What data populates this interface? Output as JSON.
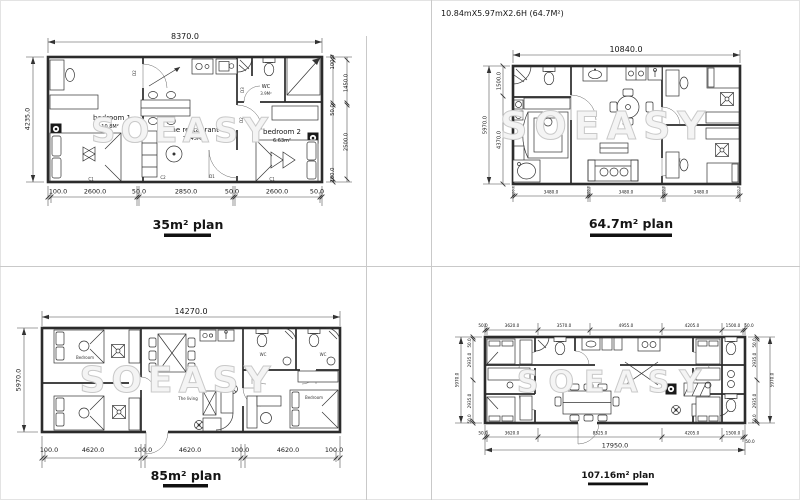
{
  "watermark": "SOEASY",
  "plans": {
    "p35": {
      "title": "35m² plan",
      "dim_top": "8370.0",
      "dim_left": "4235.0",
      "dims_right": [
        "100.0",
        "1450.0",
        "50.0",
        "2500.0",
        "100.0"
      ],
      "dims_bottom": [
        "100.0",
        "2600.0",
        "50.0",
        "2850.0",
        "50.0",
        "2600.0",
        "50.0"
      ],
      "rooms": {
        "bedroom1": {
          "name": "bedroom 1",
          "area": "10.8M²"
        },
        "restaurant": {
          "name": "The restaurant",
          "area": "12.45M²"
        },
        "bedroom2": {
          "name": "bedroom 2",
          "area": "6.63m²"
        },
        "wc": {
          "name": "WC",
          "area": "3.9M²"
        }
      },
      "door_labels": {
        "d1": "D1",
        "d2a": "D2",
        "d2b": "D2",
        "d3": "D3",
        "c1a": "C1",
        "c1b": "C1",
        "c2": "C2"
      }
    },
    "p64": {
      "header": "10.84mX5.97mX2.6H  (64.7M²)",
      "title": "64.7m²  plan",
      "dim_top": "10840.0",
      "dim_left_outer": "5970.0",
      "dims_left": [
        "1500.0",
        "4370.0"
      ],
      "dims_bottom": [
        "100.0",
        "3480.0",
        "100.0",
        "3480.0",
        "100.0",
        "3480.0",
        "100.0"
      ]
    },
    "p85": {
      "title": "85m² plan",
      "dim_top": "14270.0",
      "dim_left": "5970.0",
      "dims_bottom": [
        "100.0",
        "4620.0",
        "100.0",
        "4620.0",
        "100.0",
        "4620.0",
        "100.0"
      ],
      "rooms": {
        "bedroom_tl": "Bedroom",
        "bedroom_r": "Bedroom",
        "living": "The living",
        "wc1": "WC",
        "wc2": "WC"
      }
    },
    "p107": {
      "title": "107.16m² plan",
      "dims_top": [
        "50.0",
        "3620.0",
        "3570.0",
        "4955.0",
        "4205.0",
        "1500.0",
        "50.0"
      ],
      "dims_bottom": [
        "50.0",
        "3620.0",
        "8525.0",
        "4205.0",
        "1500.0",
        "50.0"
      ],
      "dim_total": "17950.0",
      "dim_left_outer": "5970.0",
      "dims_left": [
        "50.0",
        "2935.0",
        "2935.0",
        "50.0"
      ],
      "dim_right_outer": "5970.0",
      "dims_right": [
        "50.0",
        "2935.0",
        "2935.0",
        "50.0"
      ]
    }
  }
}
